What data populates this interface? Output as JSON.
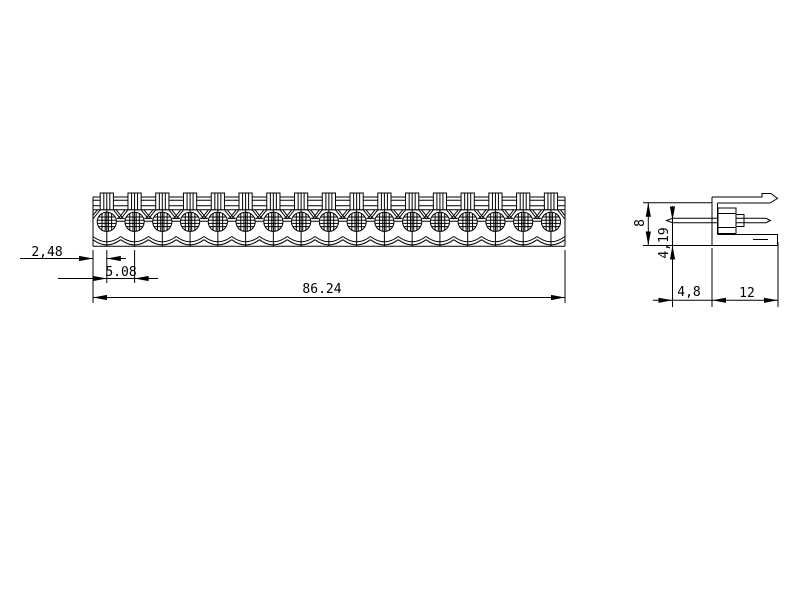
{
  "drawing": {
    "background_color": "#ffffff",
    "line_color": "#000000",
    "pin_count": 17,
    "dims": {
      "end_margin": "2,48",
      "pitch": "5.08",
      "total_length": "86.24",
      "height": "8",
      "pin_offset": "4,19",
      "pin_protrusion": "4,8",
      "depth": "12"
    }
  }
}
